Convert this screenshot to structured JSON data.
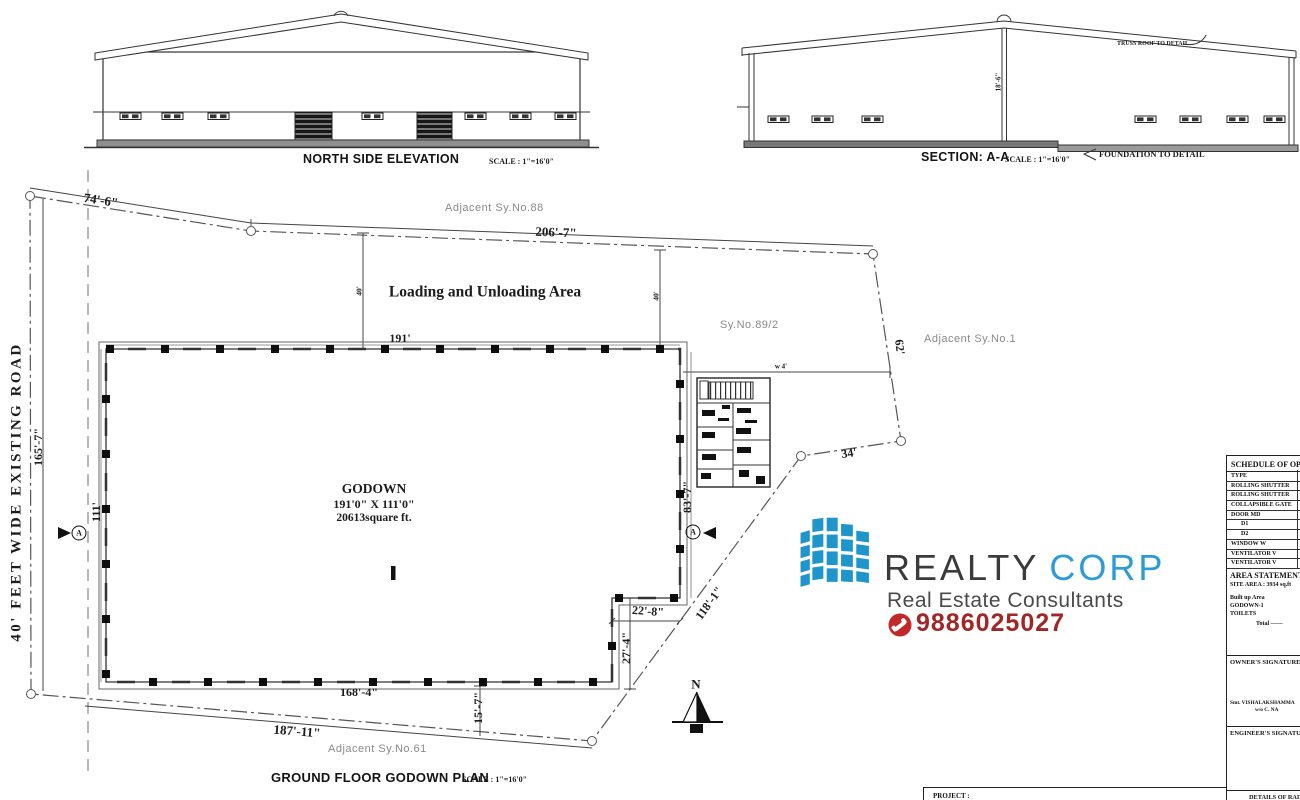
{
  "drawings": {
    "north_elevation": {
      "title": "NORTH SIDE ELEVATION",
      "scale": "SCALE : 1\"=16'0\""
    },
    "section": {
      "title": "SECTION: A-A",
      "scale": "SCALE : 1\"=16'0\"",
      "truss_note": "TRUSS ROOF TO DETAIL",
      "foundation_note": "FOUNDATION TO DETAIL",
      "height_dim": "18'-6\""
    },
    "plan": {
      "title": "GROUND FLOOR GODOWN PLAN",
      "scale": "SCALE : 1\"=16'0\""
    }
  },
  "site": {
    "road_label": "40'  FEET  WIDE  EXISTING ROAD",
    "loading_area_label": "Loading and Unloading Area",
    "survey_no": "Sy.No.89/2",
    "adjacent_north": "Adjacent  Sy.No.88",
    "adjacent_east": "Adjacent  Sy.No.1",
    "adjacent_south": "Adjacent  Sy.No.61",
    "north_letter": "N",
    "section_marker": "A"
  },
  "godown": {
    "name": "GODOWN",
    "dimensions": "191'0\" X 111'0\"",
    "area": "20613square ft."
  },
  "dims": {
    "boundary_nw": "74'-6\"",
    "boundary_n": "206'-7\"",
    "boundary_w": "165'-7\"",
    "boundary_e": "62'",
    "boundary_se": "34'",
    "boundary_diag": "118'-1\"",
    "boundary_s": "187'-11\"",
    "godown_w": "191'",
    "godown_h": "111'",
    "godown_right": "83'-7\"",
    "step_w": "22'-8\"",
    "step_h": "27'-4\"",
    "setback_s": "15'-7\"",
    "godown_s": "168'-4\"",
    "loading_left": "40'",
    "loading_right": "40'",
    "office_note": "w 4'"
  },
  "logo": {
    "brand1": "REALTY",
    "brand2": "CORP",
    "tagline": "Real Estate Consultants",
    "phone": "9886025027",
    "colors": {
      "logo_blue": "#1e96cc",
      "brand_dark": "#3b3b3b",
      "corp_blue": "#2b9cd8",
      "phone_red": "#a12626",
      "badge_red": "#c32727"
    }
  },
  "panel": {
    "schedule": {
      "title": "SCHEDULE OF OPENINGS",
      "header": "TYPE",
      "rows": [
        "ROLLING SHUTTER",
        "ROLLING SHUTTER",
        "COLLAPSIBLE GATE",
        "DOOR MD",
        "D1",
        "D2",
        "WINDOW W",
        "VENTILATOR V",
        "VENTILATOR V"
      ]
    },
    "area_statement": {
      "title": "AREA STATEMENT",
      "site_area": "SITE AREA  : 3934 sq.ft",
      "built_up": "Built up Area",
      "row1": "GODOWN-1",
      "row2": "TOILETS",
      "total": "Total  ——"
    },
    "owner_label": "OWNER'S SIGNATURE :",
    "owner_name": "Smt. VISHALAKSHAMMA",
    "owner_name2": "w/o C. NA",
    "engineer_label": "ENGINEER'S SIGNATURE",
    "details_line1": "DETAILS OF RAIN",
    "details_line2": "HARVESTING SYSTEM",
    "project_label": "PROJECT :"
  }
}
